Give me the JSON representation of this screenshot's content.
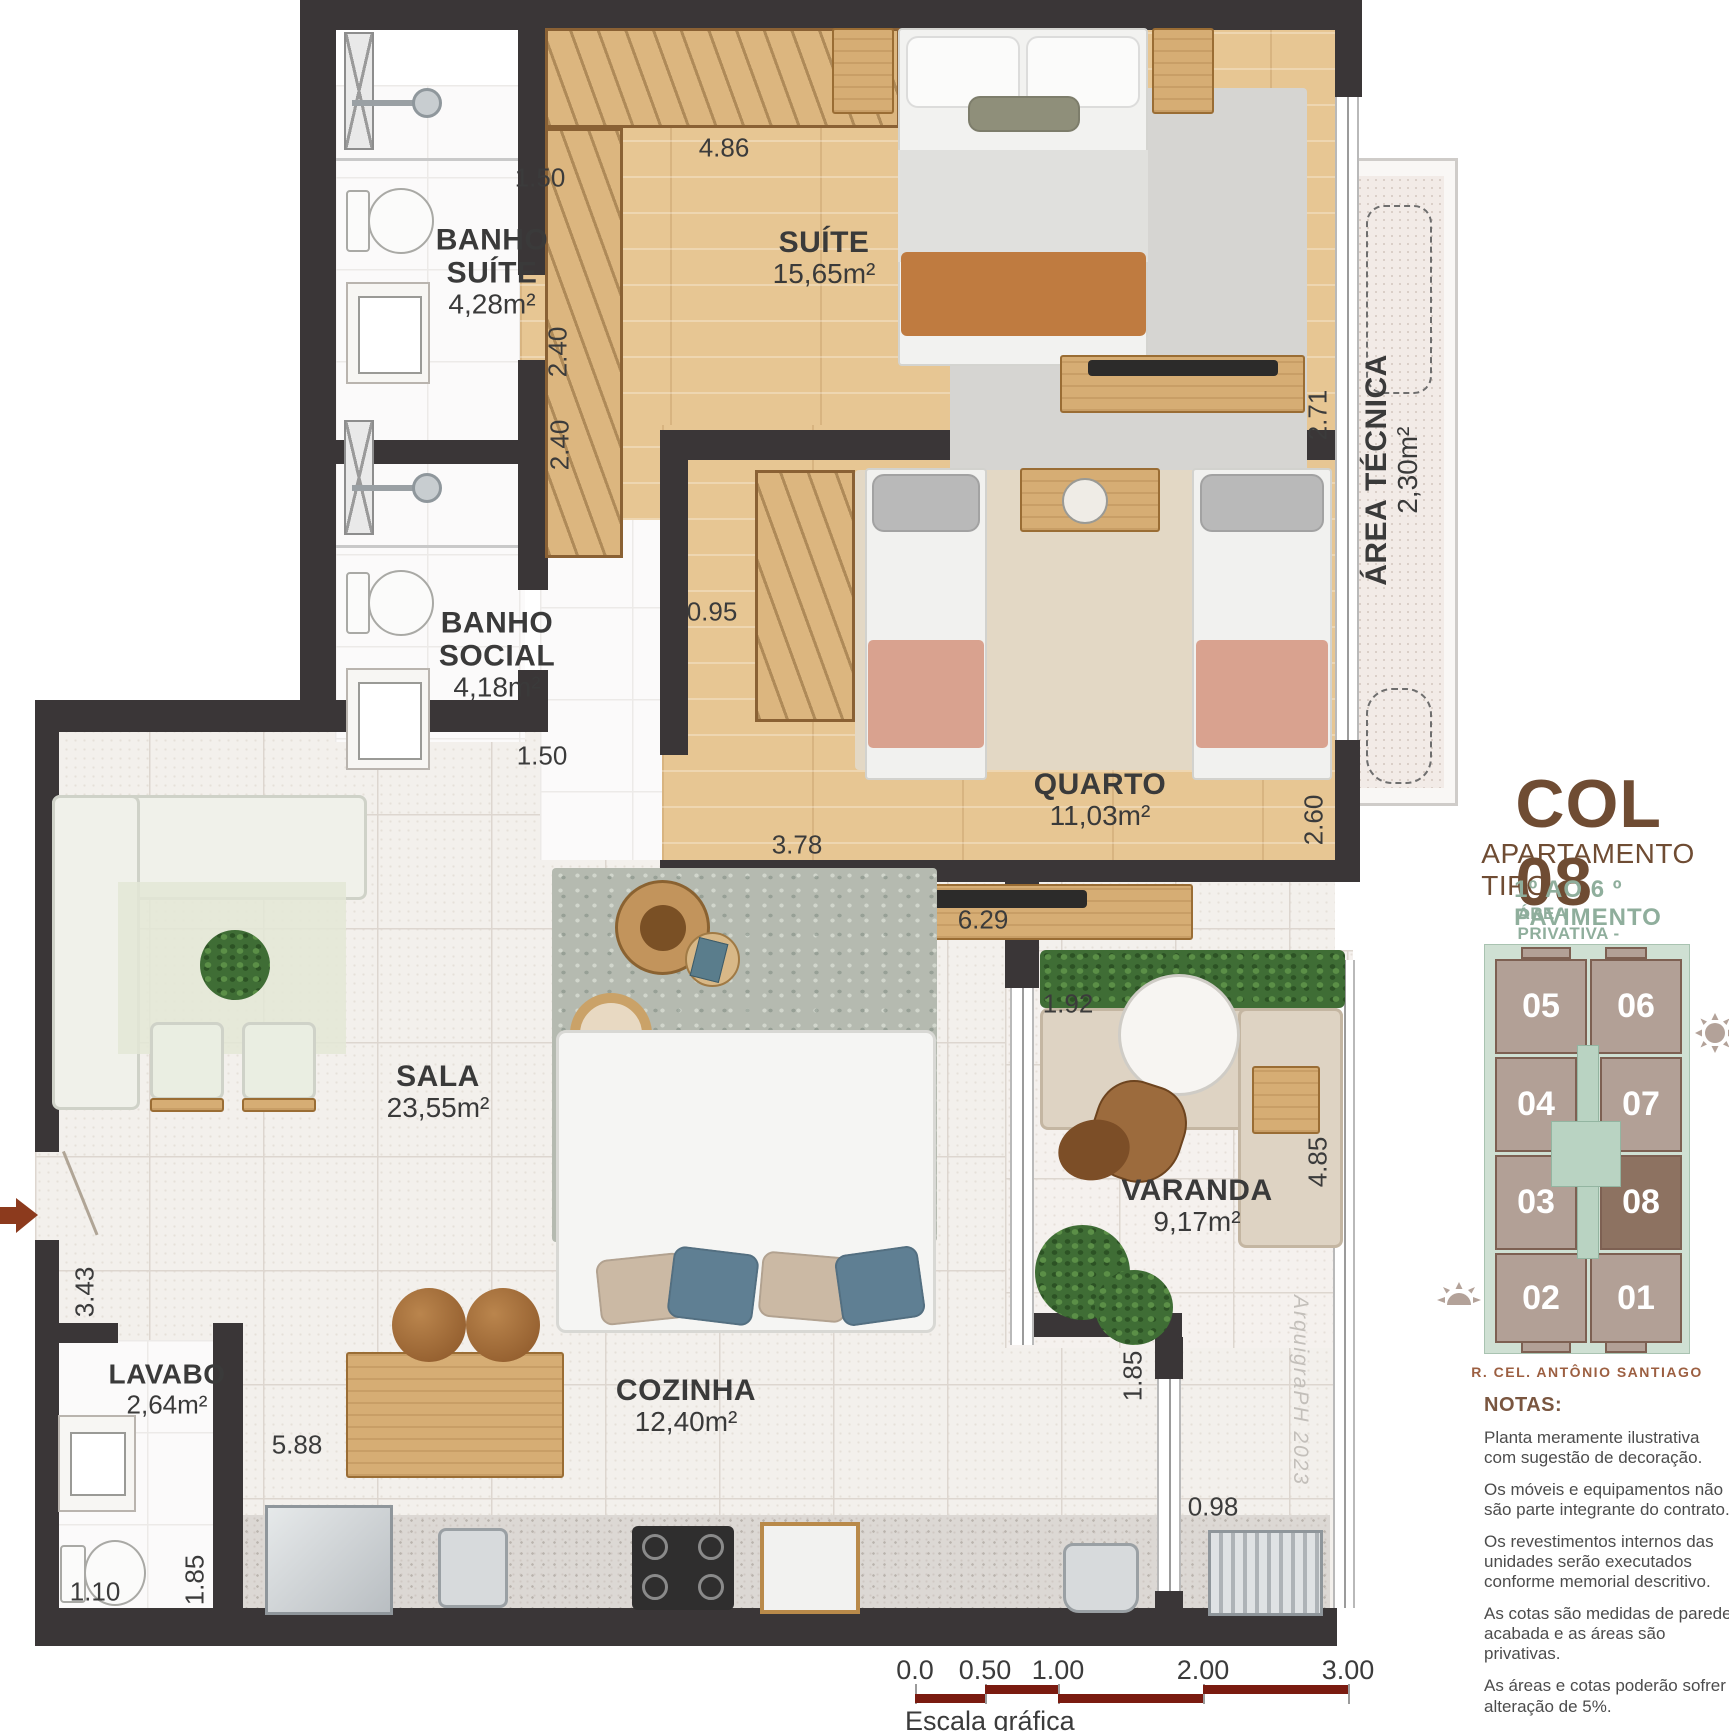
{
  "title_block": {
    "unit": "COL 08",
    "subtitle": "APARTAMENTO TIPO",
    "floors": "1º AO 6 º PAVIMENTO",
    "private_area": "ÁREA PRIVATIVA - 85,20 M²"
  },
  "keyplan": {
    "units": [
      "05",
      "06",
      "04",
      "07",
      "03",
      "08",
      "02",
      "01"
    ],
    "highlighted_unit": "08",
    "street": "R. CEL. ANTÔNIO SANTIAGO"
  },
  "notes": {
    "title": "NOTAS:",
    "items": [
      "Planta meramente ilustrativa com sugestão de decoração.",
      "Os móveis e equipamentos não são parte integrante do contrato.",
      "Os revestimentos internos das unidades serão executados conforme memorial descritivo.",
      "As cotas são medidas de parede acabada e as áreas são privativas.",
      "As áreas e cotas poderão sofrer alteração de 5%."
    ]
  },
  "rooms": {
    "banho_suite": {
      "line1": "BANHO",
      "line2": "SUÍTE",
      "area": "4,28m²"
    },
    "banho_social": {
      "line1": "BANHO",
      "line2": "SOCIAL",
      "area": "4,18m²"
    },
    "suite": {
      "name": "SUÍTE",
      "area": "15,65m²"
    },
    "quarto": {
      "name": "QUARTO",
      "area": "11,03m²"
    },
    "sala": {
      "name": "SALA",
      "area": "23,55m²"
    },
    "varanda": {
      "name": "VARANDA",
      "area": "9,17m²"
    },
    "cozinha": {
      "name": "COZINHA",
      "area": "12,40m²"
    },
    "lavabo": {
      "name": "LAVABO",
      "area": "2,64m²"
    },
    "area_tecnica": {
      "name": "ÁREA TÉCNICA",
      "area": "2,30m²"
    }
  },
  "dims": {
    "bs_top": "1.50",
    "bs_right": "2.40",
    "bsoc_right": "2.40",
    "bsoc_bot": "1.50",
    "closet": "4.86",
    "hall": "0.95",
    "quarto_w": "3.78",
    "sideboard": "6.29",
    "suite_r": "2.71",
    "quarto_r": "2.60",
    "var_top": "1.92",
    "var_r": "4.85",
    "entry": "3.43",
    "kitchen": "5.88",
    "lav_w": "1.10",
    "lav_h": "1.85",
    "serv_h": "1.85",
    "serv_w": "0.98"
  },
  "scalebar": {
    "labels": [
      "0.0",
      "0.50",
      "1.00",
      "2.00",
      "3.00"
    ],
    "caption": "Escala gráfica"
  },
  "signature": "ArquigraPH 2023",
  "colors": {
    "wall": "#3a3637",
    "wood_floor": "#e7c693",
    "accent_brown": "#6f4c33",
    "sage_green": "#8fae9c",
    "scalebar_maroon": "#7a1b10",
    "keyplan_unit": "#b2a096",
    "keyplan_highlight": "#8d7261",
    "keyplan_core": "#b9d3c2",
    "entry_arrow": "#8c3a1d"
  }
}
